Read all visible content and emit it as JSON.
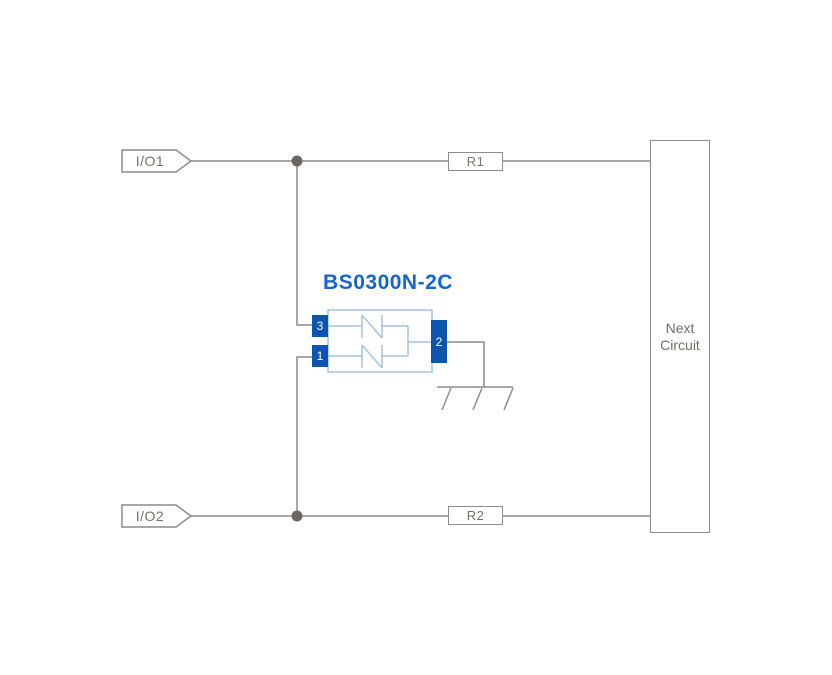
{
  "diagram": {
    "type": "circuit-schematic",
    "component": {
      "name": "BS0300N-2C",
      "pins": {
        "top_left": "3",
        "bottom_left": "1",
        "right": "2"
      }
    },
    "connectors": [
      {
        "label": "I/O1"
      },
      {
        "label": "I/O2"
      }
    ],
    "resistors": [
      {
        "label": "R1"
      },
      {
        "label": "R2"
      }
    ],
    "next_circuit": {
      "line1": "Next",
      "line2": "Circuit"
    },
    "colors": {
      "wire_gray": "#8c8c8c",
      "junction_dot": "#6b6661",
      "pin_blue": "#0d53b0",
      "title_blue": "#1565d4",
      "symbol_light_blue": "#a3c2e3",
      "label_gray": "#73716c",
      "background": "#ffffff"
    }
  }
}
